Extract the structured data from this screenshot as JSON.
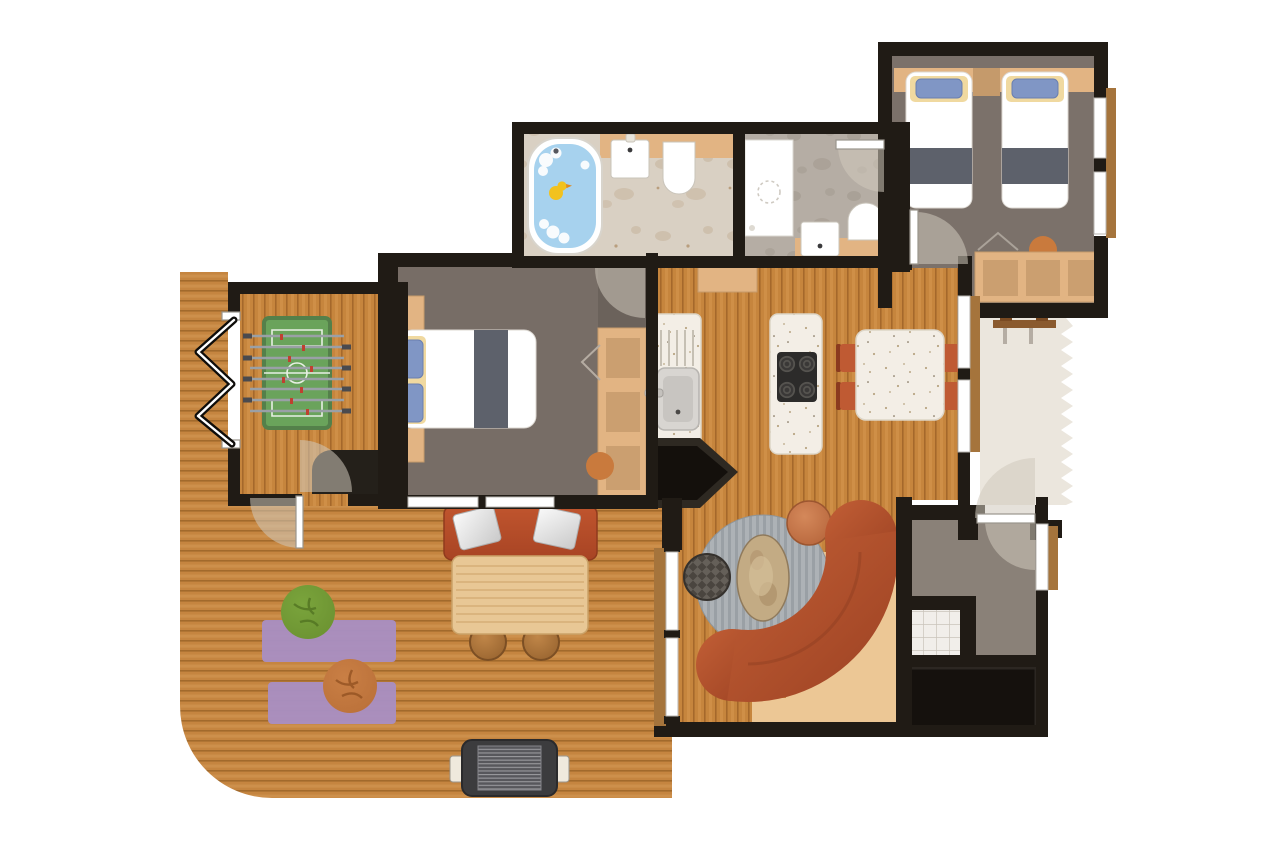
{
  "title": "apartment-floor-plan",
  "palette": {
    "wall": "#201b15",
    "wood": "#c6853d",
    "wood_dark": "#a5682b",
    "wood_light": "#d89a52",
    "deck": "#c58540",
    "deck_dark": "#a26a2c",
    "deck_light": "#d69c58",
    "floor_master": "#776d66",
    "floor_twin": "#7b716a",
    "floor_utility": "#8a8178",
    "floor_nook": "#6b625b",
    "marble": "#d9d0c3",
    "marble_blob": "#c5b29a",
    "stone": "#b5ada4",
    "stone_blob": "#a2998e",
    "hall": "#ebe6dd",
    "tan": "#e2b483",
    "tan_dark": "#c59a6b",
    "counter_white": "#f3eee6",
    "speck_dot": "#b9a684",
    "glass_frame": "#b9b6b0",
    "leaf_border": "#9a958d",
    "bed_stripe": "#5d616b",
    "pillow": "#8096c5",
    "pillow_glow": "#f0d9a0",
    "sofa_a": "#c25f36",
    "sofa_b": "#9c4122",
    "chair": "#bf5a33",
    "chair_dark": "#8a3a1f",
    "rug": "#adb2b6",
    "rug_stripe": "#9aa0a5",
    "coffee": "#c3ab84",
    "pouf": "#4a453f",
    "pouf_light": "#6b665f",
    "ottoman_a": "#d4885a",
    "ottoman_b": "#b5643a",
    "bean_green": "#6a9030",
    "bean_green_dark": "#4f7020",
    "bean_orange": "#b96f38",
    "bean_orange_dark": "#8f4f1f",
    "mat": "#a98fc2",
    "foos_field": "#6aa35b",
    "foos_edge": "#54804a",
    "water": "#a7d2ee",
    "duck": "#f2c21e",
    "grill": "#3c3c3e",
    "grill_grate": "#9a9a9e",
    "tile": "#f1eeea",
    "tile_line": "#c9c3ba",
    "sill": "#a5743c",
    "arc": "#cfc8bc"
  },
  "floorplan": {
    "type": "apartment-floor-plan",
    "rooms": [
      {
        "id": "terrace",
        "furniture": [
          "deck",
          "garden-bench",
          "bench-cushions",
          "picnic-table",
          "stools",
          "barbecue-grill",
          "yoga-mats",
          "bean-bag-green",
          "bean-bag-orange"
        ]
      },
      {
        "id": "games-room",
        "furniture": [
          "foosball-table",
          "folding-door",
          "corner-unit"
        ]
      },
      {
        "id": "master-bedroom",
        "furniture": [
          "double-bed",
          "nightstands",
          "wardrobe",
          "windows"
        ]
      },
      {
        "id": "family-bathroom",
        "furniture": [
          "bathtub",
          "rubber-duck",
          "washbasin",
          "toilet"
        ]
      },
      {
        "id": "shower-room",
        "furniture": [
          "shower",
          "washbasin",
          "toilet"
        ]
      },
      {
        "id": "twin-bedroom",
        "furniture": [
          "single-bed-left",
          "single-bed-right",
          "headboard-shelf",
          "wardrobe"
        ]
      },
      {
        "id": "kitchen-dining",
        "furniture": [
          "sink-counter",
          "cooktop-island",
          "dining-table",
          "dining-chairs",
          "wall-cabinet",
          "fireplace"
        ]
      },
      {
        "id": "entry-walkway",
        "furniture": [
          "coat-rack",
          "entry-door",
          "torn-plan-edge"
        ]
      },
      {
        "id": "living-room",
        "furniture": [
          "curved-sofa",
          "round-rug",
          "coffee-table",
          "pouf",
          "ottoman",
          "glass-doors"
        ]
      },
      {
        "id": "utility-room",
        "furniture": [
          "tiled-shower-closet",
          "window"
        ]
      },
      {
        "id": "storage-closet",
        "furniture": []
      }
    ]
  }
}
